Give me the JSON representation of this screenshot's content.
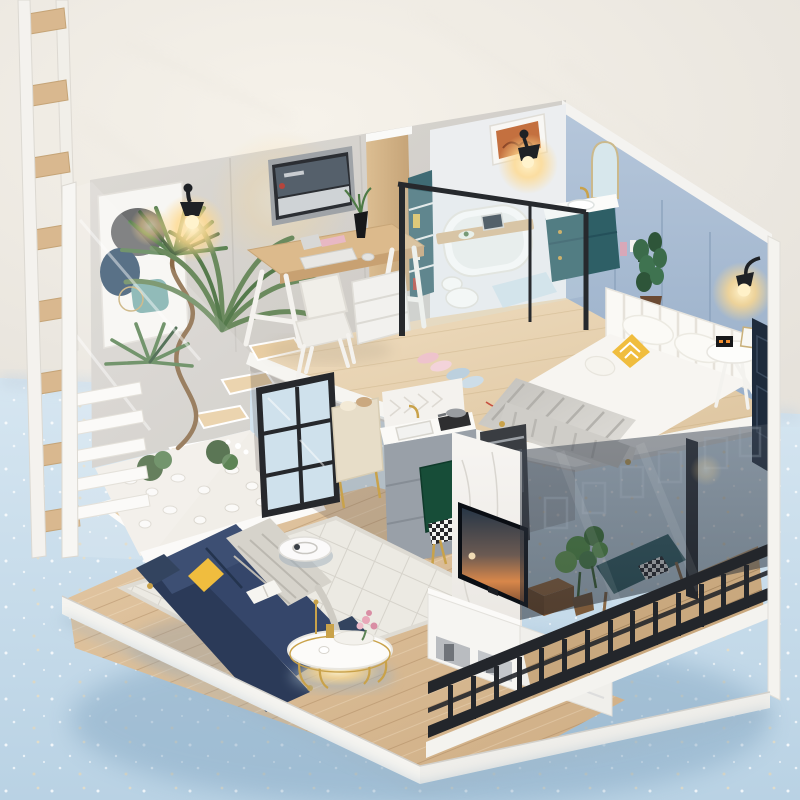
{
  "scene": {
    "title": "DIY miniature dollhouse photo — modern two-story loft apartment on a pale blue table against a white plaster wall",
    "rooms": [
      "home office",
      "bathroom",
      "bedroom",
      "atrium garden",
      "living room",
      "kitchen",
      "tv corner",
      "balcony"
    ],
    "objects": {
      "ladder": "decorative wooden ladder",
      "poster": "abstract wall art poster",
      "palm": "large palm plant",
      "garden": "white pebble atrium garden",
      "stairs": "floating wood stairs",
      "desk": "office desk with computer",
      "computer": "desktop computer",
      "chair": "white office chair",
      "divider": "wood partition with shelf",
      "bathtub": "white bathtub with tray",
      "vanity": "teal bathroom vanity",
      "mirror": "arched mirror",
      "partition": "black framed glass partition",
      "bed": "double bed with knit blanket",
      "headboard": "white channel headboard",
      "nightstand": "round white nightstand",
      "lamp": "black wall lamp, lit",
      "slippers": "fuzzy slippers",
      "window": "black frame window",
      "kitchen": "grey kitchenette with marble top",
      "dining_chair": "green dining chair",
      "sofa": "navy blue sofa with grey throw",
      "coffee_table": "round gold coffee table",
      "vacuum": "white robot vacuum",
      "rug": "cream diamond-grid rug",
      "tv": "flat screen tv on marble wall",
      "console": "white media console",
      "box": "wooden storage box",
      "balcony": "balcony with dark metal railing",
      "glass": "smoked glass panel",
      "bench": "teal balcony bench",
      "plant_pot": "plant in gold pot"
    }
  },
  "palette": {
    "backdrop_warm": "#f6f2ea",
    "backdrop_grey": "#e6e2db",
    "surface_light": "#d6e6f1",
    "surface_deep": "#b9d2e4",
    "concrete_light": "#dedbd6",
    "concrete_dark": "#c6c3be",
    "bedroom_wall_light": "#b6c7db",
    "bedroom_wall_dark": "#98aec8",
    "wood_divider_light": "#dcbe92",
    "wood_divider_dark": "#c4a276",
    "loft_wood_light": "#efddc0",
    "loft_wood_dark": "#ddc49e",
    "floor_wood_light": "#e3c8a4",
    "floor_wood_dark": "#cfae85",
    "balcony_wood": "#c9a87e",
    "sofa_navy": "#35466a",
    "sofa_navy_dark": "#2b3a58",
    "accent_yellow": "#f0bd3e",
    "accent_gold": "#c9a24a",
    "cabinet_teal": "#2e5f66",
    "cabinet_grey": "#99a0a8",
    "panel_navy": "#1e2b3c",
    "railing_iron": "#23262b",
    "lamp_glow": "#ffd98d",
    "plant_green": "#5d8455",
    "plant_dark": "#3c5e41",
    "plant_bright": "#58a044",
    "tv_sky": "#273646",
    "tv_sunset": "#d8874a",
    "marble_white": "#f7f5f2",
    "knit_grey": "#c9c7c2",
    "rug_cream": "#eceae3",
    "pebble_white": "#f1eee8",
    "robot_white": "#fbfafa"
  }
}
